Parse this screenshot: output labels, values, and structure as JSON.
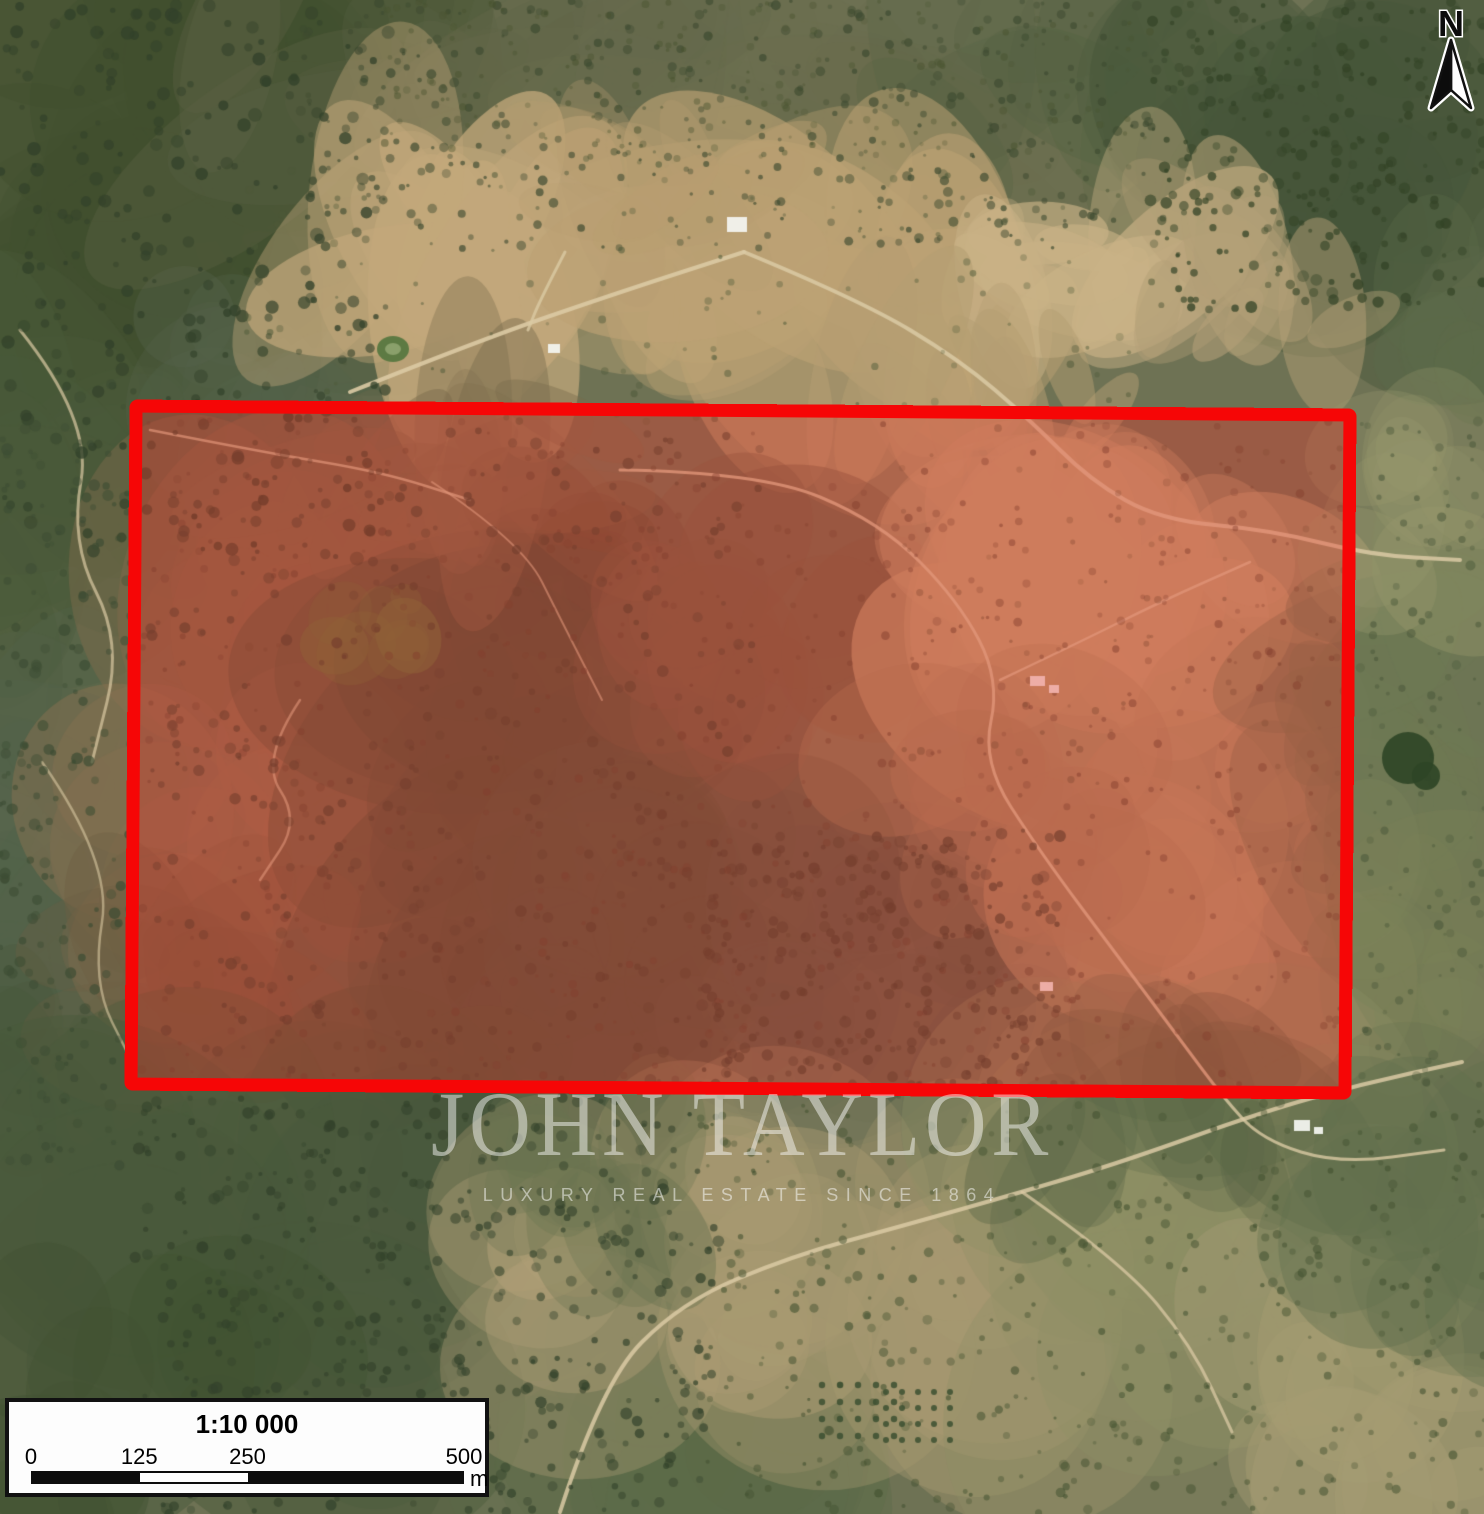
{
  "map": {
    "kind": "satellite-aerial-view",
    "north_arrow_label": "N",
    "property_boundary_color": "#F60606",
    "property_fill_color": "rgba(236,48,38,0.34)"
  },
  "watermark": {
    "title": "JOHN TAYLOR",
    "subtitle": "LUXURY REAL ESTATE SINCE 1864"
  },
  "scale_bar": {
    "ratio_label": "1:10 000",
    "tick_labels": [
      "0",
      "125",
      "250",
      "500"
    ],
    "unit_label": "m"
  }
}
